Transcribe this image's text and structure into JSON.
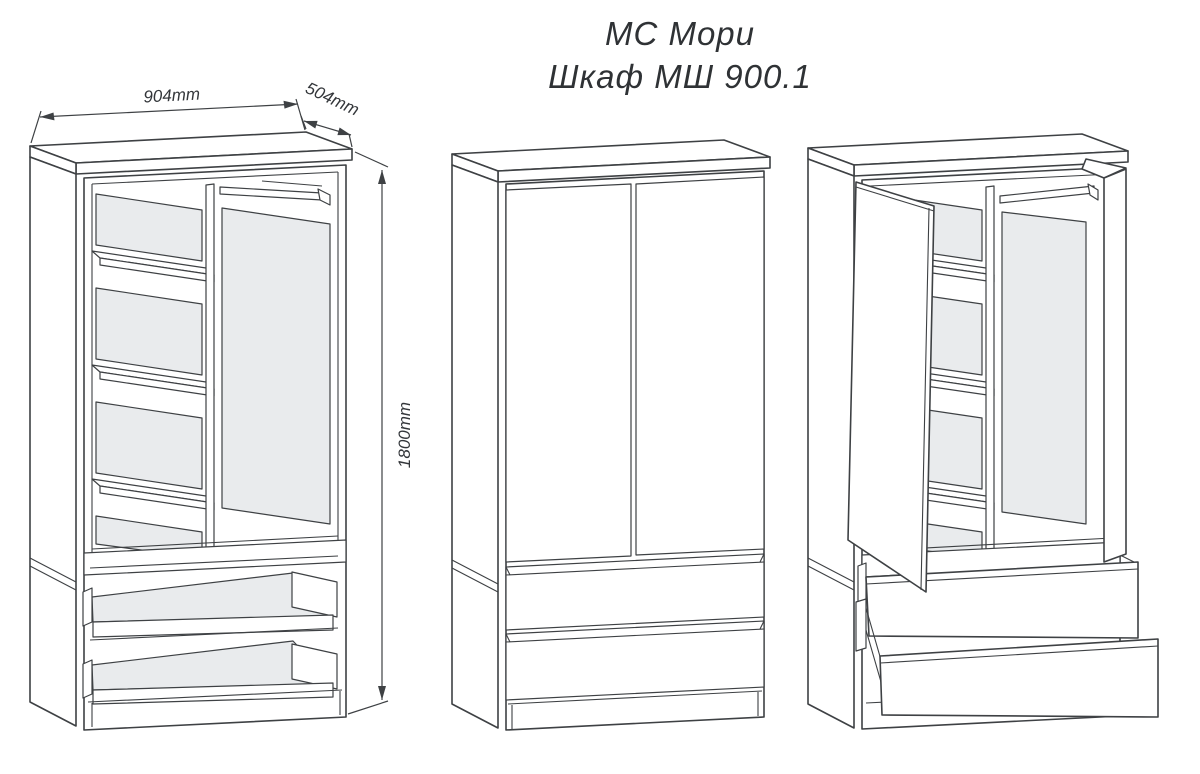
{
  "title": {
    "line1": "МС Мори",
    "line2": "Шкаф МШ 900.1"
  },
  "dimensions": {
    "width": "904mm",
    "depth": "504mm",
    "height": "1800mm"
  },
  "colors": {
    "line": "#3e4144",
    "panel_fill": "#e9ebed",
    "background": "#ffffff",
    "text": "#2f3235"
  }
}
